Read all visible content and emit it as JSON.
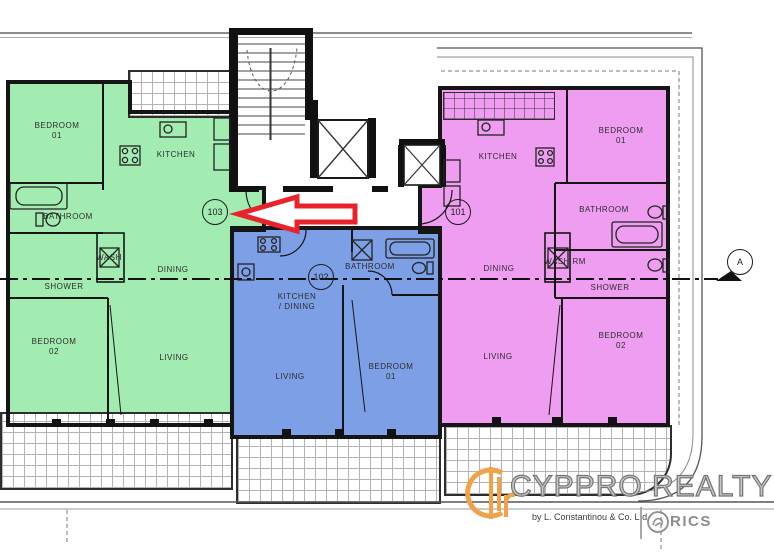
{
  "units": {
    "unit_103": {
      "number": "103",
      "rooms": {
        "bedroom1": "BEDROOM\n01",
        "kitchen": "KITCHEN",
        "bathroom": "BATHROOM",
        "wash": "WASH",
        "shower": "SHOWER",
        "dining": "DINING",
        "bedroom2": "BEDROOM\n02",
        "living": "LIVING"
      }
    },
    "unit_102": {
      "number": "102",
      "rooms": {
        "kitchen_dining": "KITCHEN\n/ DINING",
        "bathroom": "BATHROOM",
        "living": "LIVING",
        "bedroom1": "BEDROOM\n01"
      }
    },
    "unit_101": {
      "number": "101",
      "rooms": {
        "kitchen": "KITCHEN",
        "bedroom1": "BEDROOM\n01",
        "bathroom": "BATHROOM",
        "wash": "WASH RM",
        "dining": "DINING",
        "shower": "SHOWER",
        "living": "LIVING",
        "bedroom2": "BEDROOM\n02"
      }
    }
  },
  "section_marker": "A",
  "logo": {
    "brand": "CYPPRO REALTY",
    "byline": "by L. Constantinou & Co. Ltd",
    "rics_label": "RICS"
  },
  "colors": {
    "unit_103": "#a2ecb2",
    "unit_102": "#7d9fe6",
    "unit_101": "#ee9df0",
    "arrow_red": "#e8232b",
    "logo_orange": "#f0a24b",
    "logo_gray": "#8d8d8d"
  }
}
